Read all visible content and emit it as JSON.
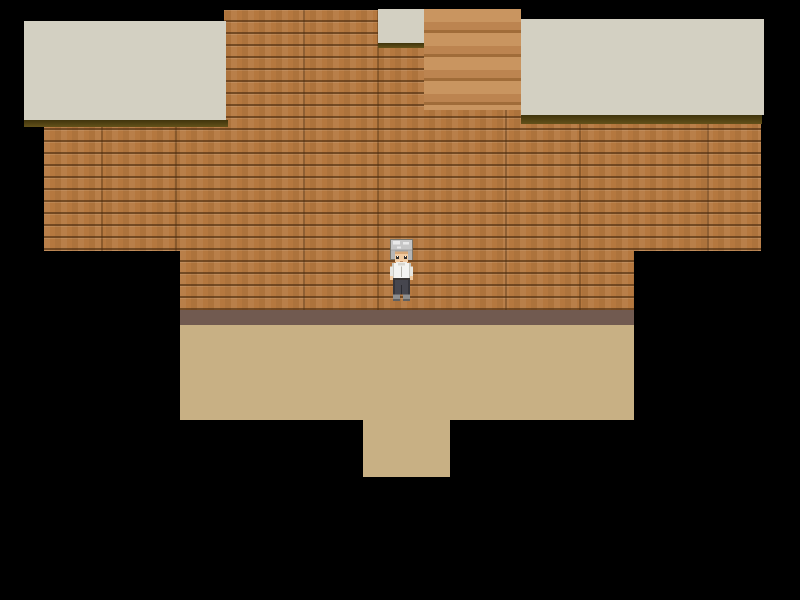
{
  "scene": {
    "description": "Top-down RPG interior: wood-plank room on black void with ceiling blocks, staircase, tan floor and doorway opening at bottom",
    "player": {
      "character": "elderly man sprite",
      "facing": "down",
      "hair": "gray tousled",
      "outfit": "white long-sleeve shirt, dark trousers, gray shoes"
    },
    "elements": [
      {
        "name": "ceiling-block-left",
        "kind": "ceiling tile"
      },
      {
        "name": "ceiling-block-top-center",
        "kind": "ceiling tile above doorway"
      },
      {
        "name": "staircase",
        "kind": "wooden steps"
      },
      {
        "name": "ceiling-block-right",
        "kind": "ceiling tile"
      },
      {
        "name": "wall-wood-planks",
        "kind": "plank wall"
      },
      {
        "name": "baseboard",
        "kind": "wall base strip"
      },
      {
        "name": "floor",
        "kind": "walkable tan floor"
      },
      {
        "name": "floor-doorway-extension",
        "kind": "exit passage at bottom"
      }
    ]
  },
  "colors": {
    "bg": "#000000",
    "ceiling": "#d3d0c2",
    "ceiling-edge": "#63511a",
    "ceiling-edge-dark": "#3f340c",
    "wall-plank": "#b5783f",
    "wall-seam": "#7a4e22",
    "stairs-light": "#c99560",
    "stairs-mid": "#bc8450",
    "stairs-line": "#a06c39",
    "baseboard": "#715a50",
    "floor": "#c8b084",
    "hair": "#c6c6c6",
    "hair-shade": "#a3a3a3",
    "skin": "#f1cba1",
    "shirt": "#f4f4f0",
    "pants": "#46464e",
    "shoes": "#8f8f8f"
  }
}
